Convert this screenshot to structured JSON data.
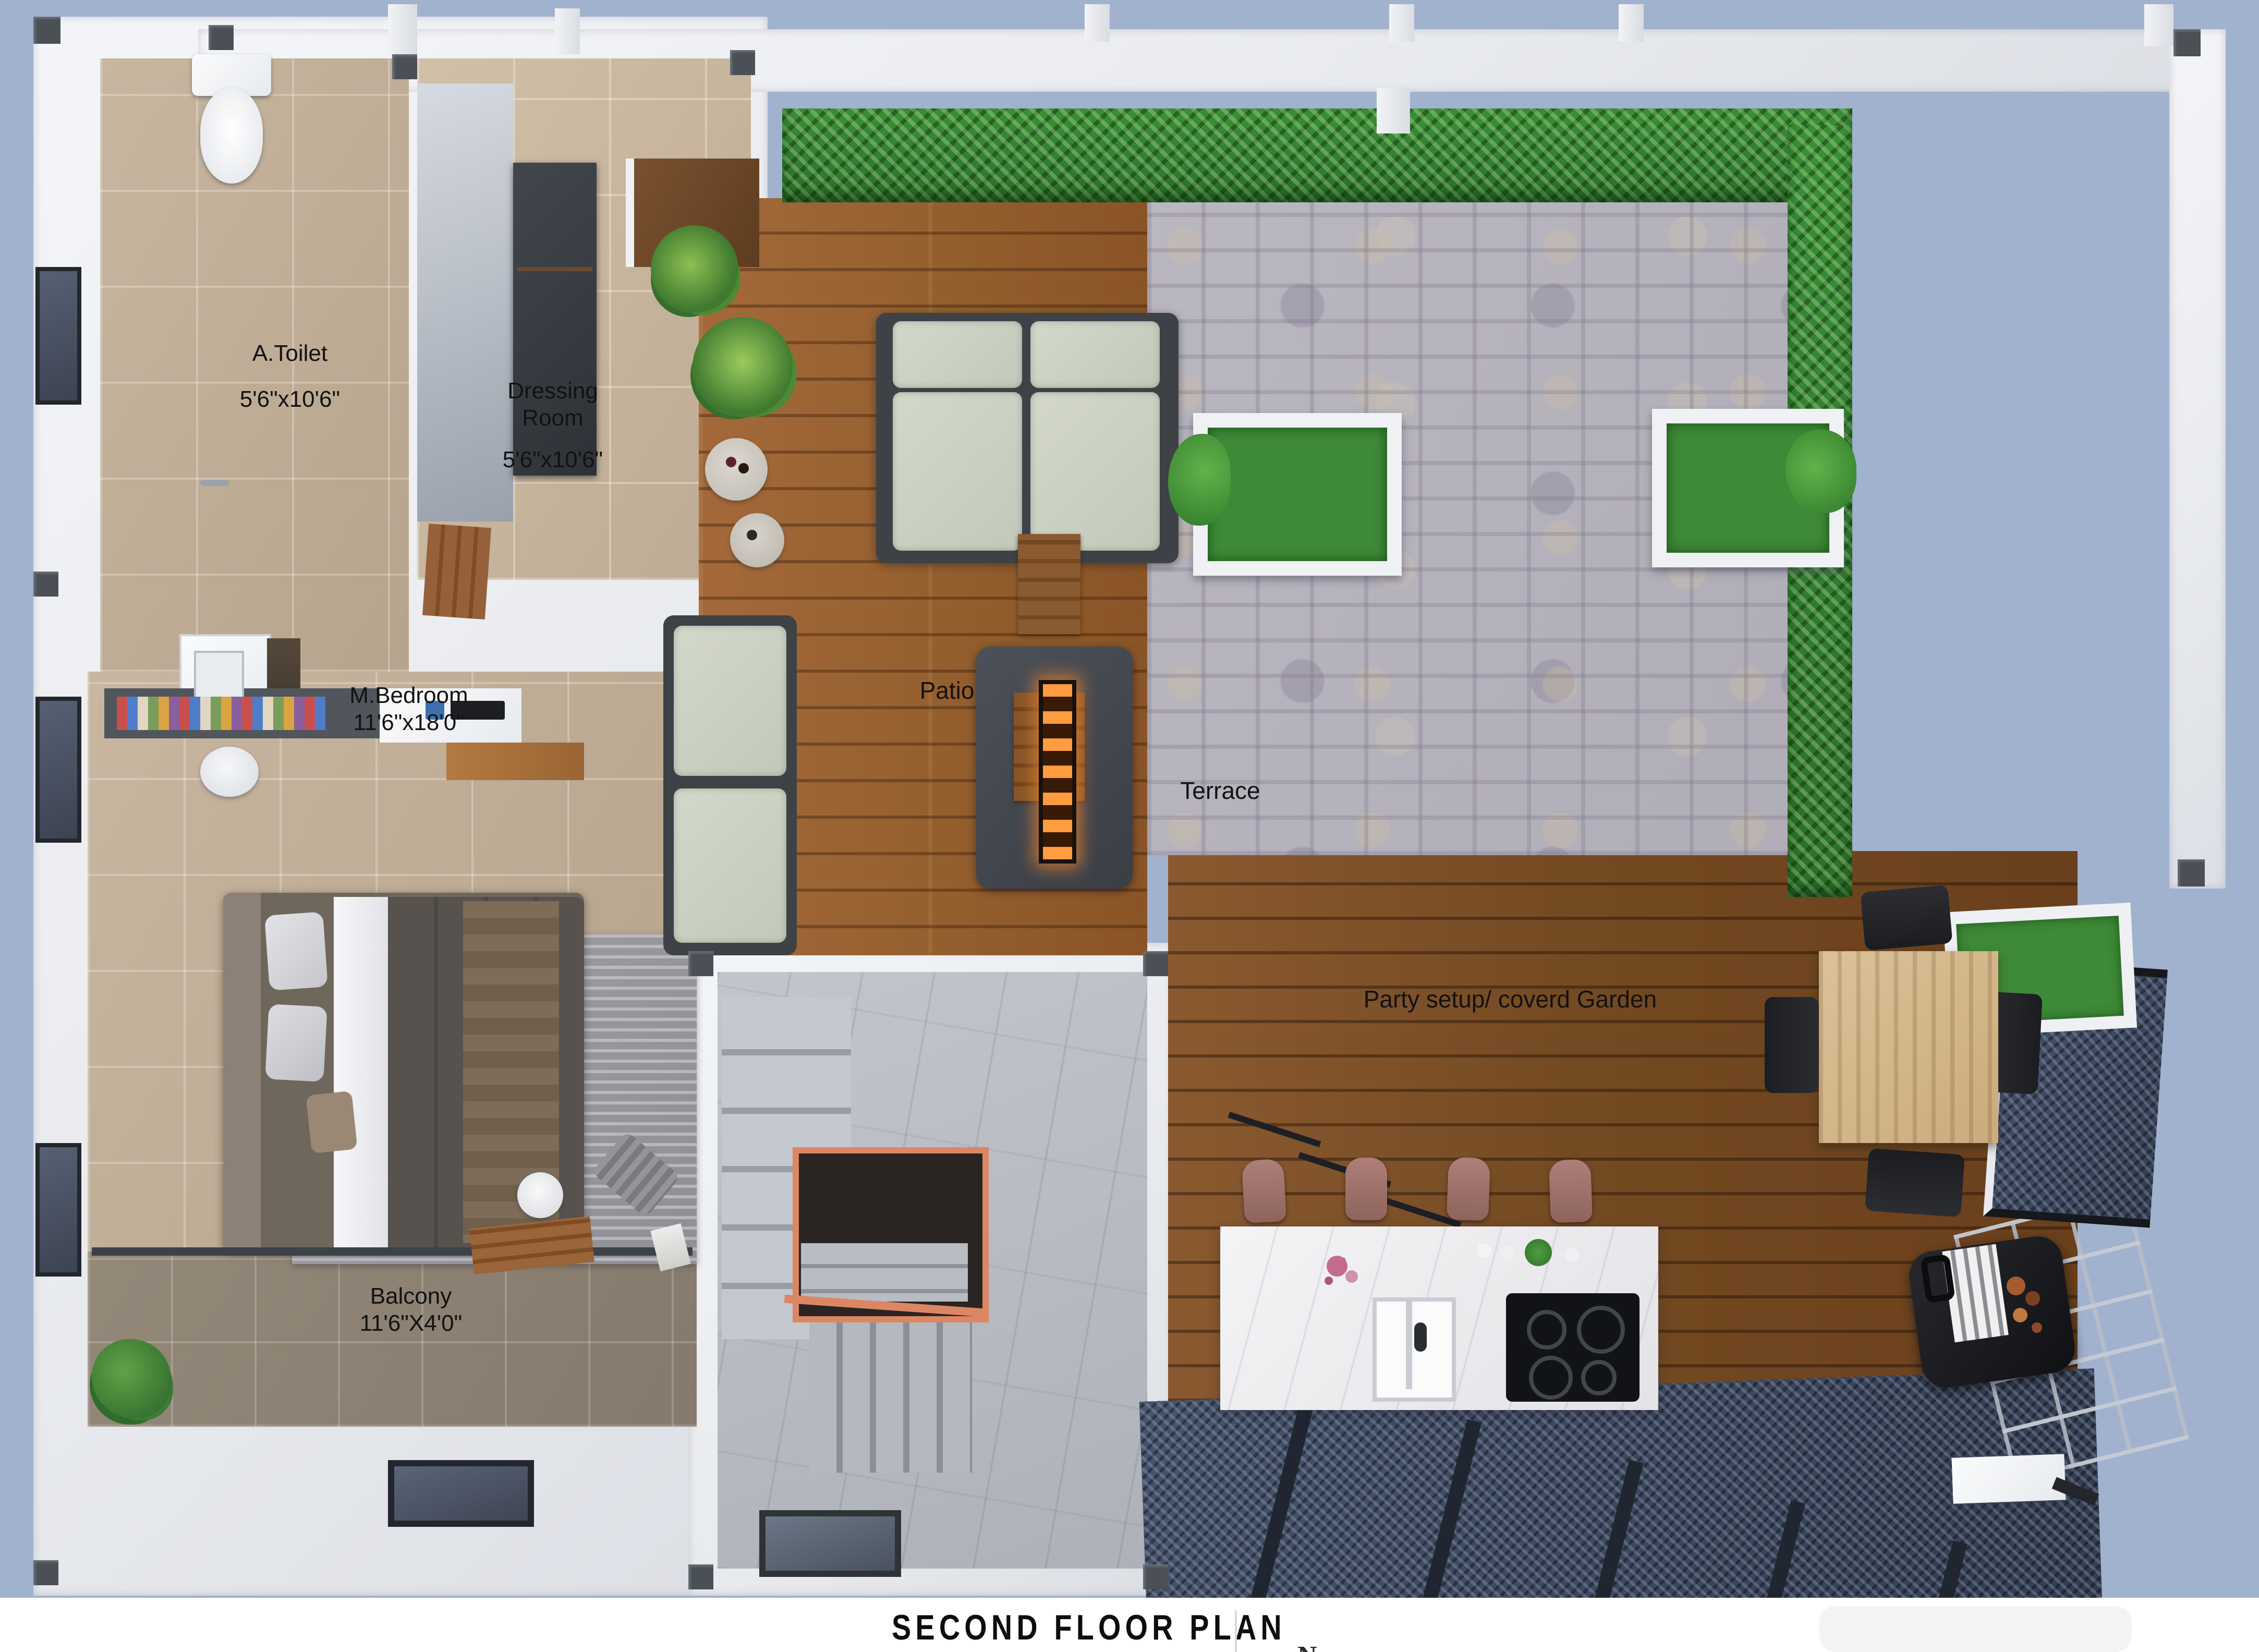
{
  "title": "SECOND FLOOR PLAN",
  "north_marker": "N",
  "rooms": {
    "toilet": {
      "name": "A.Toilet",
      "dims": "5'6\"x10'6\""
    },
    "dressing": {
      "line1": "Dressing",
      "line2": "Room",
      "dims": "5'6\"x10'6\""
    },
    "bedroom": {
      "name": "M.Bedroom",
      "dims": "11'6\"x18'0\""
    },
    "balcony": {
      "name": "Balcony",
      "dims": "11'6\"X4'0\""
    },
    "patio": {
      "name": "Patio"
    },
    "terrace": {
      "name": "Terrace"
    },
    "party": {
      "name": "Party setup/ coverd Garden"
    }
  },
  "colors": {
    "background": "#a1b2cf",
    "wall_white": "#eef0f2",
    "hedge_green": "#348232",
    "patio_wood": "#99622f",
    "party_wood": "#74481f",
    "terrace_stone": "#b6b3bd",
    "bedroom_floor": "#c2b098",
    "stair_accent_orange": "#dd8663",
    "pergola_mesh": "#3c4a66",
    "fire_glow": "#ff9c3f"
  }
}
